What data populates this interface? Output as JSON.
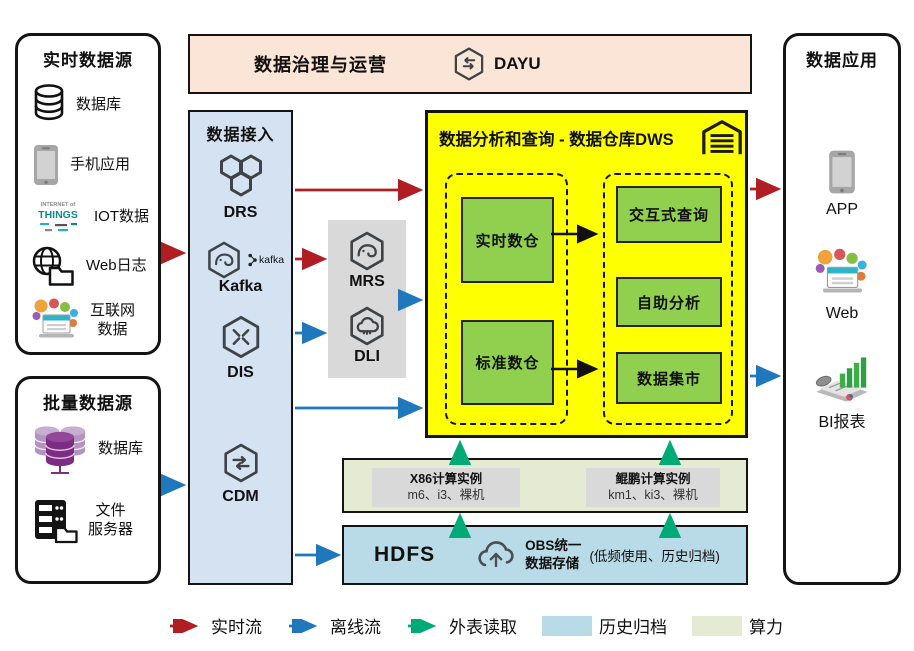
{
  "palette": {
    "realtime_flow": "#b01e23",
    "offline_flow": "#1f78bb",
    "external_read": "#00aa77",
    "archive_fill": "#b9dbe7",
    "compute_fill": "#e4ebd2",
    "dws_fill": "#feff00",
    "warehouse_green": "#90d04e",
    "access_fill": "#d5e2f1",
    "banner_fill": "#fbe5d6",
    "gray_fill": "#d9d9d9"
  },
  "realtime_sources": {
    "title": "实时数据源",
    "items": [
      {
        "icon": "database-icon",
        "label": "数据库"
      },
      {
        "icon": "phone-icon",
        "label": "手机应用"
      },
      {
        "icon": "iot-wordcloud-icon",
        "label": "IOT数据"
      },
      {
        "icon": "globe-folder-icon",
        "label": "Web日志"
      },
      {
        "icon": "internet-bubbles-icon",
        "label": "互联网\n数据"
      }
    ]
  },
  "batch_sources": {
    "title": "批量数据源",
    "items": [
      {
        "icon": "database-cluster-icon",
        "label": "数据库"
      },
      {
        "icon": "file-server-icon",
        "label": "文件\n服务器"
      }
    ]
  },
  "governance": {
    "title": "数据治理与运营",
    "product": "DAYU"
  },
  "access": {
    "title": "数据接入",
    "services": [
      {
        "name": "DRS"
      },
      {
        "name": "Kafka",
        "badge": "kafka"
      },
      {
        "name": "DIS"
      },
      {
        "name": "CDM"
      }
    ]
  },
  "processing": {
    "services": [
      {
        "name": "MRS"
      },
      {
        "name": "DLI"
      }
    ]
  },
  "dws": {
    "title": "数据分析和查询 - 数据仓库DWS",
    "warehouses": [
      "实时数仓",
      "标准数仓"
    ],
    "services": [
      "交互式查询",
      "自助分析",
      "数据集市"
    ]
  },
  "compute": {
    "instances": [
      {
        "title": "X86计算实例",
        "spec": "m6、i3、裸机"
      },
      {
        "title": "鲲鹏计算实例",
        "spec": "km1、ki3、裸机"
      }
    ]
  },
  "storage": {
    "hdfs": "HDFS",
    "obs": "OBS统一\n数据存储",
    "note": "(低频使用、历史归档)"
  },
  "apps": {
    "title": "数据应用",
    "items": [
      {
        "icon": "app-phone-icon",
        "label": "APP"
      },
      {
        "icon": "web-portal-icon",
        "label": "Web"
      },
      {
        "icon": "bi-report-icon",
        "label": "BI报表"
      }
    ]
  },
  "legend": {
    "items": [
      {
        "kind": "arrow",
        "color": "#b01e23",
        "label": "实时流"
      },
      {
        "kind": "arrow",
        "color": "#1f78bb",
        "label": "离线流"
      },
      {
        "kind": "arrow",
        "color": "#00aa77",
        "label": "外表读取"
      },
      {
        "kind": "swatch",
        "color": "#b9dbe7",
        "label": "历史归档"
      },
      {
        "kind": "swatch",
        "color": "#e4ebd2",
        "label": "算力"
      }
    ]
  }
}
